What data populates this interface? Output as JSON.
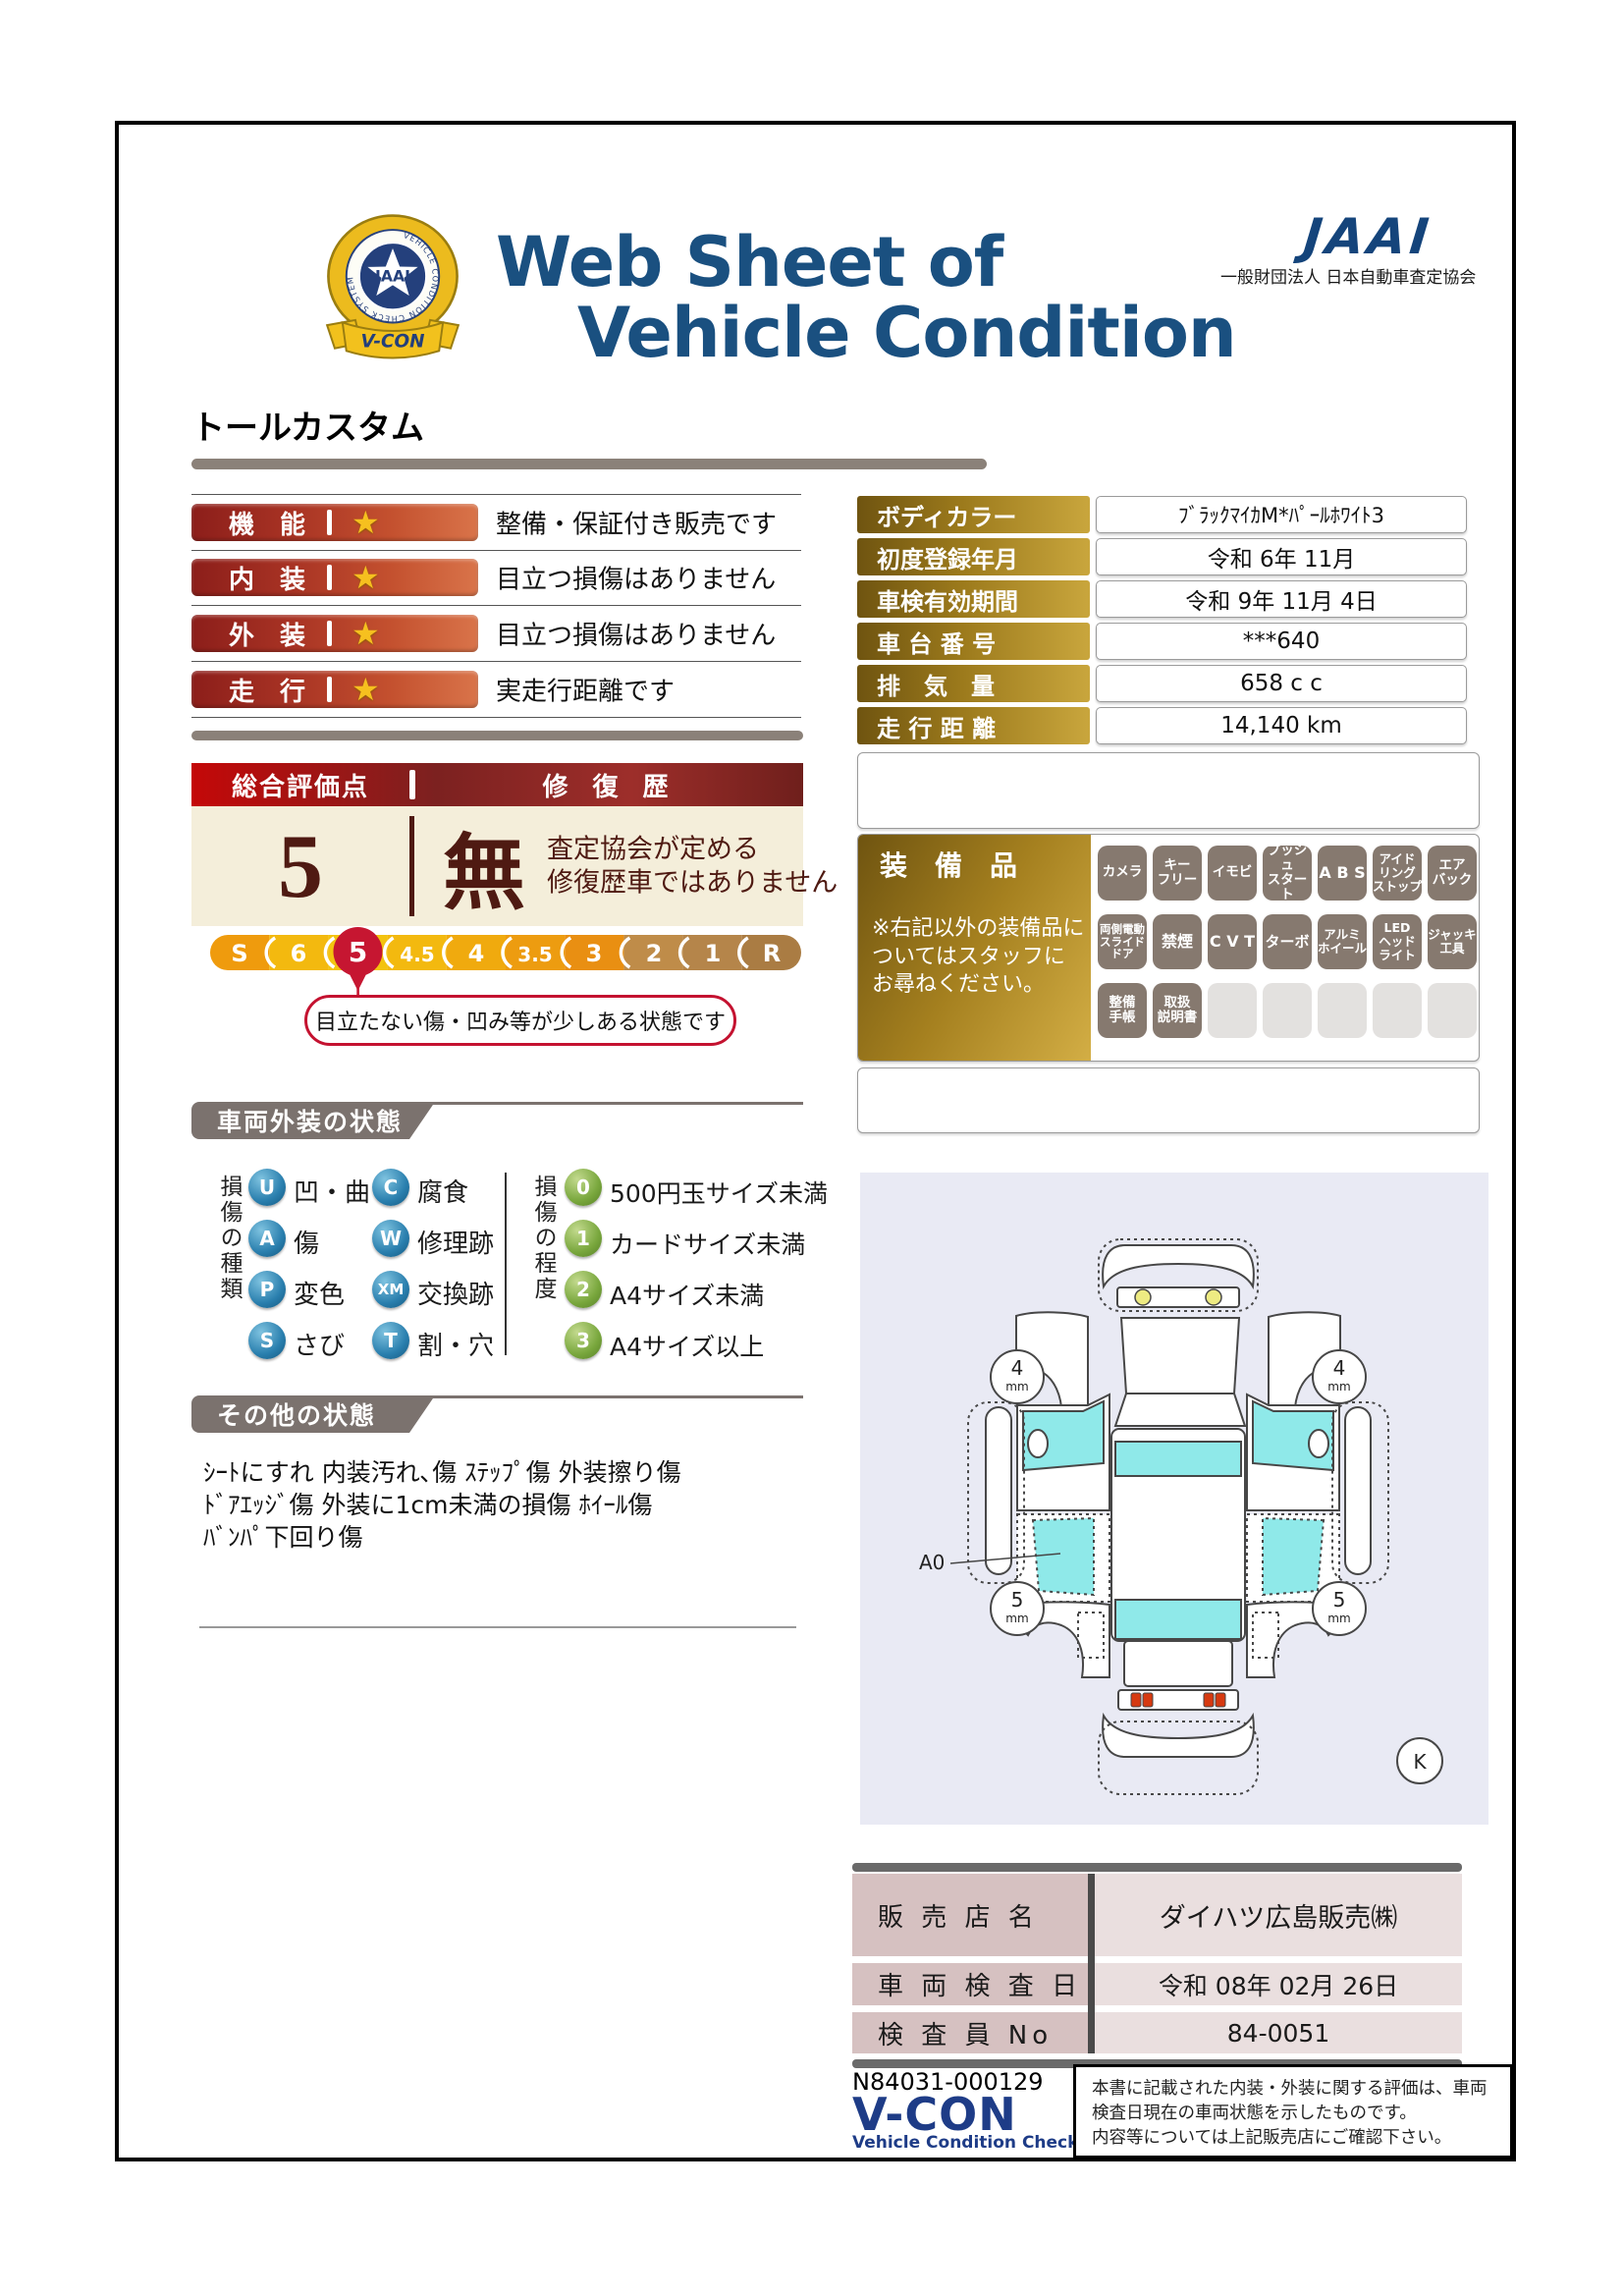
{
  "header": {
    "emblem": {
      "ring_text": "VEHICLE CONDITION CHECK SYSTEM",
      "star_text": "JAAI",
      "ribbon_text": "V-CON"
    },
    "title_line1": "Web Sheet of",
    "title_line2": "Vehicle Condition",
    "jaai_logo": "JAAI",
    "jaai_subtitle": "一般財団法人 日本自動車査定協会"
  },
  "model_name": "トールカスタム",
  "ratings": [
    {
      "label": "機　能",
      "desc": "整備・保証付き販売です"
    },
    {
      "label": "内　装",
      "desc": "目立つ損傷はありません"
    },
    {
      "label": "外　装",
      "desc": "目立つ損傷はありません"
    },
    {
      "label": "走　行",
      "desc": "実走行距離です"
    }
  ],
  "overall": {
    "header_left": "総合評価点",
    "header_right": "修 復 歴",
    "score": "5",
    "repair": "無",
    "repair_note_line1": "査定協会が定める",
    "repair_note_line2": "修復歴車ではありません",
    "scale": [
      "S",
      "6",
      "5",
      "4.5",
      "4",
      "3.5",
      "3",
      "2",
      "1",
      "R"
    ],
    "selected": "5",
    "scale_note": "目立たない傷・凹み等が少しある状態です",
    "selected_color": "#c61631"
  },
  "vehicle_info": {
    "rows": [
      {
        "label": "ボディカラー",
        "value": "ﾌﾞﾗｯｸﾏｲｶM*ﾊﾟｰﾙﾎﾜｲﾄ3"
      },
      {
        "label": "初度登録年月",
        "value": "令和 6年 11月"
      },
      {
        "label": "車検有効期間",
        "value": "令和 9年 11月 4日"
      },
      {
        "label": "車 台 番 号",
        "value": "***640"
      },
      {
        "label": "排　気　量",
        "value": "658 c c"
      },
      {
        "label": "走 行 距 離",
        "value": "14,140 km"
      }
    ]
  },
  "equipment": {
    "title": "装　備　品",
    "note": "※右記以外の装備品に\nついてはスタッフに\nお尋ねください。",
    "badges": [
      "カメラ",
      "キー\nフリー",
      "イモビ",
      "プッシュ\nスタート",
      "A B S",
      "アイド\nリング\nストップ",
      "エア\nバック",
      "両側電動\nスライド\nドア",
      "禁煙",
      "C V T",
      "ターボ",
      "アルミ\nホイール",
      "LED\nヘッド\nライト",
      "ジャッキ\n工具",
      "整備\n手帳",
      "取扱\n説明書"
    ],
    "empty_count": 5
  },
  "exterior": {
    "section_title": "車両外装の状態",
    "damage_kind_label": "損傷の種類",
    "kinds": [
      {
        "code": "U",
        "label": "凹・曲"
      },
      {
        "code": "C",
        "label": "腐食"
      },
      {
        "code": "A",
        "label": "傷"
      },
      {
        "code": "W",
        "label": "修理跡"
      },
      {
        "code": "P",
        "label": "変色"
      },
      {
        "code": "XM",
        "label": "交換跡"
      },
      {
        "code": "S",
        "label": "さび"
      },
      {
        "code": "T",
        "label": "割・穴"
      }
    ],
    "damage_degree_label": "損傷の程度",
    "degrees": [
      {
        "code": "0",
        "label": "500円玉サイズ未満"
      },
      {
        "code": "1",
        "label": "カードサイズ未満"
      },
      {
        "code": "2",
        "label": "A4サイズ未満"
      },
      {
        "code": "3",
        "label": "A4サイズ以上"
      }
    ]
  },
  "other": {
    "section_title": "その他の状態",
    "lines": [
      "ｼｰﾄにすれ 内装汚れ､傷 ｽﾃｯﾌﾟ傷 外装擦り傷",
      "ﾄﾞｱｴｯｼﾞ傷 外装に1cm未満の損傷 ﾎｲｰﾙ傷",
      "ﾊﾞﾝﾊﾟ下回り傷"
    ]
  },
  "diagram": {
    "front_tire_left": "4",
    "front_tire_right": "4",
    "rear_tire_left": "5",
    "rear_tire_right": "5",
    "tire_unit": "mm",
    "annotation": "A0",
    "corner_mark": "K"
  },
  "dealer": {
    "rows": [
      {
        "label": "販 売 店 名",
        "value": "ダイハツ広島販売㈱"
      },
      {
        "label": "車 両 検 査 日",
        "value": "令和 08年 02月 26日"
      },
      {
        "label": "検 査 員 No",
        "value": "84-0051"
      }
    ]
  },
  "footer": {
    "doc_number": "N84031-000129",
    "vcon_logo": "V-CON",
    "vcon_subtitle": "Vehicle Condition Check System",
    "disclaimer_lines": [
      "本書に記載された内装・外装に関する評価は、車両",
      "検査日現在の車両状態を示したものです。",
      "内容等については上記販売店にご確認下さい。"
    ]
  },
  "colors": {
    "title_blue": "#1a5080",
    "rating_bar_gradient_start": "#8c1e1a",
    "rating_bar_gradient_end": "#d9744a",
    "overall_cream": "#f4eeda",
    "maroon_text": "#4f1a12",
    "gold_dark": "#6f5410",
    "gold_light": "#c9a63d",
    "badge_gray": "#86796f",
    "section_gray": "#7b726e",
    "diagram_bg": "#e9eaf4",
    "window_cyan": "#8fe9e9",
    "dealer_pink_label": "#d6c1c1",
    "dealer_pink_value": "#eadfdf",
    "vcon_blue": "#1e3c87",
    "selected_crimson": "#c61631"
  }
}
